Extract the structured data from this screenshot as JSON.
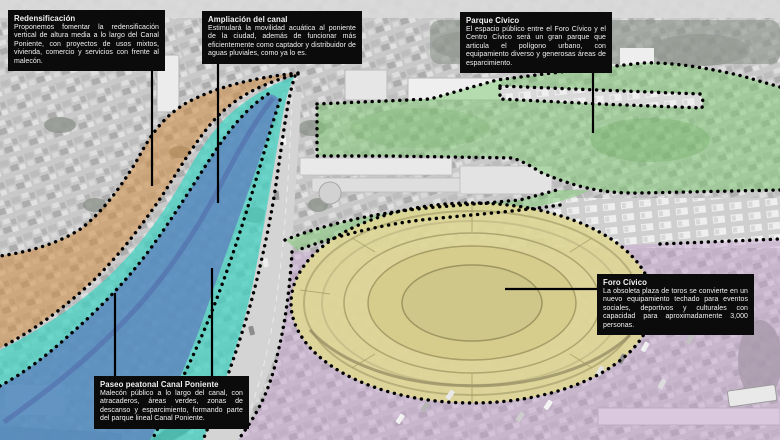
{
  "figure": {
    "type": "annotated-aerial-urban-plan",
    "description_language": "es"
  },
  "annotations": {
    "redensificacion": {
      "title": "Redensificación",
      "body": "Proponemos fomentar la redensificación vertical de altura media a lo largo del Canal Poniente, con proyectos de usos mixtos, vivienda, comercio y servicios con frente al malecón."
    },
    "ampliacion_canal": {
      "title": "Ampliación del canal",
      "body": "Estimulará la movilidad acuática al poniente de la ciudad, además de funcionar más eficientemente como captador y distribuidor de aguas pluviales, como ya lo es."
    },
    "parque_civico": {
      "title": "Parque Cívico",
      "body": "El espacio público entre el Foro Cívico y el Centro Cívico será un gran parque que articula el polígono urbano, con equipamiento diverso y generosas áreas de esparcimiento."
    },
    "foro_civico": {
      "title": "Foro Cívico",
      "body": "La obsoleta plaza de toros se convierte en un nuevo equipamiento techado para eventos sociales, deportivos y culturales con capacidad para aproximadamente 3,000 personas."
    },
    "paseo_peatonal": {
      "title": "Paseo peatonal Canal Poniente",
      "body": "Malecón público a lo largo del canal, con atracaderos, áreas verdes, zonas de descanso y esparcimiento, formando parte del parque lineal Canal Poniente."
    }
  },
  "zones": {
    "redensificacion_band": {
      "color": "#D08A3E"
    },
    "paseo_peatonal_band": {
      "color": "#3FD1C0"
    },
    "canal_band": {
      "color": "#5E74BE"
    },
    "parque_zone": {
      "color": "#7CC96F"
    },
    "foro_zone": {
      "color": "#DED796"
    },
    "south_east_zone": {
      "color": "#C79FD0"
    }
  },
  "style_colors": {
    "annotation_bg": "#0B0B0B",
    "annotation_text": "#F2F2F2",
    "outline_dots": "#000000",
    "leader_line": "#000000"
  }
}
